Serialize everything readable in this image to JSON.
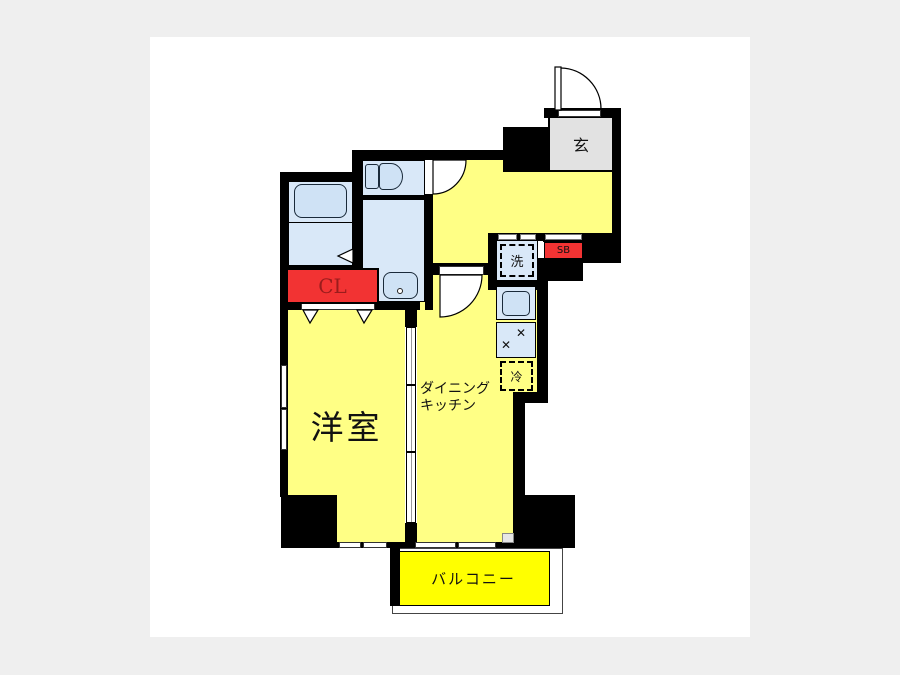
{
  "title": "apartment-floor-plan",
  "colors": {
    "wall": "#000000",
    "room_yellow": "#ffff85",
    "balcony_yellow": "#ffff00",
    "wet_area_blue": "#d9e8f8",
    "fixture_blue": "#cfe2f5",
    "entrance_gray": "#e2e2e2",
    "storage_red": "#f23333",
    "closet_text": "#9a1c1c",
    "page_background": "#efefef",
    "panel_background": "#ffffff"
  },
  "rooms": {
    "entrance": {
      "label": "玄"
    },
    "western_room": {
      "label": "洋室"
    },
    "dining_kitchen": {
      "line1": "ダイニング",
      "line2": "キッチン"
    },
    "balcony": {
      "label": "バルコニー"
    },
    "closet": {
      "label": "CL"
    },
    "shoe_box": {
      "label": "SB"
    },
    "washing_machine": {
      "label": "洗"
    },
    "refrigerator": {
      "label": "冷"
    }
  }
}
